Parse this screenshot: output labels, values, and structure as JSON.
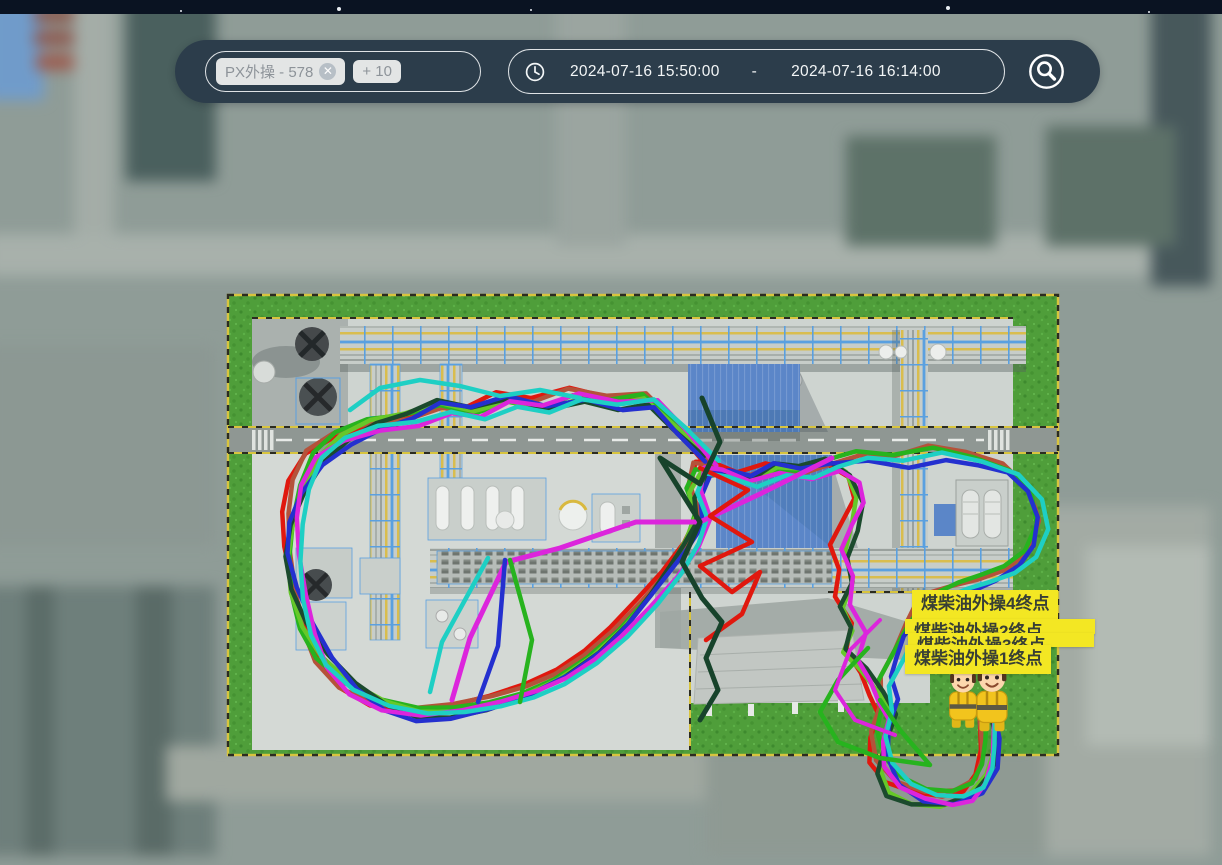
{
  "toolbar": {
    "tag_input": {
      "tags": [
        {
          "label": "PX外操 - 578",
          "closable": true
        },
        {
          "label": "+ 10",
          "closable": false
        }
      ]
    },
    "time_range": {
      "start": "2024-07-16 15:50:00",
      "separator": "-",
      "end": "2024-07-16 16:14:00"
    },
    "icons": {
      "clock": "clock-icon",
      "search": "circle-search-icon",
      "close": "close-icon"
    }
  },
  "topbar": {
    "stars": [
      [
        180,
        10,
        2
      ],
      [
        337,
        7,
        4
      ],
      [
        530,
        9,
        2
      ],
      [
        946,
        6,
        4
      ],
      [
        1148,
        11,
        2
      ]
    ]
  },
  "colors": {
    "toolbar_bg": "#2c3d4b",
    "topbar_bg": "#0a1322",
    "pill_border": "#f8fbfc",
    "chip_bg": "#e3e5e5",
    "chip_text": "#8d9399",
    "label_bg": "#f3e723",
    "label_text": "#383f35",
    "grass": "#4f9e3a",
    "concrete": "#ced4d0",
    "building_blue": "#5b86c8",
    "rack_frame_blue": "#5aa0e0",
    "pipe_yellow": "#d9bd4e"
  },
  "map": {
    "endpoint_labels": [
      {
        "text": "煤柴油外操4终点",
        "x": 912,
        "y": 590,
        "clip": false
      },
      {
        "text": "煤柴油外操2终点",
        "x": 905,
        "y": 619,
        "clip": true,
        "w": 172,
        "clip_h": 13
      },
      {
        "text": "煤柴油外操3终点",
        "x": 908,
        "y": 633,
        "clip": true,
        "w": 168,
        "clip_h": 12
      },
      {
        "text": "煤柴油外操1终点",
        "x": 905,
        "y": 645,
        "clip": false
      }
    ],
    "workers": {
      "count": 2,
      "description": "worker-avatar-markers"
    },
    "trail_prefix": [
      [
        706,
        458
      ],
      [
        676,
        428
      ],
      [
        648,
        400
      ],
      [
        614,
        404
      ],
      [
        578,
        396
      ],
      [
        542,
        406
      ],
      [
        506,
        398
      ],
      [
        472,
        410
      ],
      [
        440,
        404
      ],
      [
        408,
        417
      ],
      [
        374,
        424
      ],
      [
        342,
        438
      ],
      [
        316,
        458
      ],
      [
        299,
        488
      ],
      [
        290,
        520
      ],
      [
        288,
        554
      ],
      [
        294,
        590
      ],
      [
        306,
        626
      ],
      [
        323,
        658
      ],
      [
        349,
        686
      ],
      [
        381,
        705
      ],
      [
        416,
        714
      ],
      [
        452,
        712
      ],
      [
        490,
        704
      ],
      [
        527,
        692
      ],
      [
        561,
        676
      ],
      [
        593,
        654
      ],
      [
        621,
        628
      ],
      [
        647,
        598
      ],
      [
        669,
        570
      ],
      [
        687,
        543
      ],
      [
        699,
        518
      ],
      [
        693,
        492
      ],
      [
        702,
        470
      ],
      [
        722,
        470
      ],
      [
        748,
        478
      ],
      [
        774,
        466
      ],
      [
        801,
        470
      ],
      [
        828,
        462
      ]
    ],
    "trail_variants": {
      "a": [
        [
          850,
          476
        ],
        [
          859,
          500
        ],
        [
          851,
          526
        ],
        [
          841,
          552
        ],
        [
          849,
          578
        ],
        [
          841,
          604
        ],
        [
          854,
          628
        ],
        [
          847,
          652
        ],
        [
          864,
          672
        ],
        [
          877,
          694
        ],
        [
          889,
          714
        ],
        [
          881,
          740
        ],
        [
          877,
          768
        ],
        [
          889,
          790
        ],
        [
          914,
          800
        ],
        [
          944,
          803
        ],
        [
          969,
          795
        ],
        [
          985,
          775
        ],
        [
          992,
          748
        ],
        [
          989,
          718
        ],
        [
          987,
          698
        ]
      ],
      "b": [
        [
          862,
          456
        ],
        [
          900,
          461
        ],
        [
          938,
          453
        ],
        [
          974,
          460
        ],
        [
          1007,
          470
        ],
        [
          1029,
          492
        ],
        [
          1037,
          520
        ],
        [
          1029,
          548
        ],
        [
          1011,
          566
        ],
        [
          987,
          578
        ],
        [
          961,
          588
        ],
        [
          937,
          598
        ],
        [
          917,
          612
        ],
        [
          904,
          632
        ],
        [
          894,
          655
        ],
        [
          884,
          678
        ],
        [
          889,
          702
        ],
        [
          881,
          728
        ],
        [
          884,
          757
        ],
        [
          899,
          781
        ],
        [
          924,
          795
        ],
        [
          953,
          797
        ],
        [
          977,
          787
        ],
        [
          989,
          765
        ],
        [
          991,
          738
        ],
        [
          988,
          712
        ],
        [
          986,
          697
        ]
      ]
    },
    "trails": [
      {
        "name": "trail-red",
        "color": "#e0180e",
        "variant": "a",
        "offset": -6,
        "amp": 5,
        "phase": 0.3
      },
      {
        "name": "trail-brown",
        "color": "#b5523a",
        "variant": "b",
        "offset": -4,
        "amp": 6,
        "phase": 1.1
      },
      {
        "name": "trail-green",
        "color": "#27b31e",
        "variant": "b",
        "offset": -2,
        "amp": 5,
        "phase": 2.2
      },
      {
        "name": "trail-lightgreen",
        "color": "#66c829",
        "variant": "a",
        "offset": 0,
        "amp": 4,
        "phase": 3.0
      },
      {
        "name": "trail-darkgreen",
        "color": "#1b4a2d",
        "variant": "a",
        "offset": 2,
        "amp": 5,
        "phase": 4.1
      },
      {
        "name": "trail-blue",
        "color": "#2430cf",
        "variant": "b",
        "offset": 4,
        "amp": 5,
        "phase": 5.0
      },
      {
        "name": "trail-magenta",
        "color": "#dc25dc",
        "variant": "a",
        "offset": 6,
        "amp": 6,
        "phase": 0.8
      },
      {
        "name": "trail-cyan",
        "color": "#1ecfc4",
        "variant": "b",
        "offset": 8,
        "amp": 5,
        "phase": 1.9
      }
    ],
    "tangles": [
      {
        "color": "#dc25dc",
        "width": 5,
        "points": [
          [
            832,
            458
          ],
          [
            760,
            494
          ],
          [
            700,
            522
          ],
          [
            636,
            522
          ],
          [
            560,
            548
          ],
          [
            506,
            562
          ],
          [
            470,
            638
          ],
          [
            452,
            700
          ]
        ]
      },
      {
        "color": "#e0180e",
        "width": 4.5,
        "points": [
          [
            700,
            468
          ],
          [
            748,
            490
          ],
          [
            710,
            516
          ],
          [
            752,
            542
          ],
          [
            700,
            566
          ],
          [
            732,
            592
          ],
          [
            760,
            572
          ],
          [
            742,
            614
          ],
          [
            706,
            640
          ]
        ]
      },
      {
        "color": "#17432b",
        "width": 5,
        "points": [
          [
            702,
            398
          ],
          [
            720,
            442
          ],
          [
            700,
            484
          ],
          [
            660,
            458
          ],
          [
            700,
            522
          ],
          [
            682,
            562
          ],
          [
            702,
            598
          ],
          [
            722,
            622
          ],
          [
            706,
            658
          ],
          [
            718,
            690
          ],
          [
            700,
            720
          ]
        ]
      },
      {
        "color": "#27b31e",
        "width": 4.5,
        "points": [
          [
            510,
            560
          ],
          [
            532,
            640
          ],
          [
            520,
            702
          ]
        ]
      },
      {
        "color": "#1ecfc4",
        "width": 4.5,
        "points": [
          [
            488,
            558
          ],
          [
            442,
            642
          ],
          [
            430,
            692
          ]
        ]
      },
      {
        "color": "#2430cf",
        "width": 4.5,
        "points": [
          [
            505,
            560
          ],
          [
            498,
            646
          ],
          [
            478,
            702
          ]
        ]
      },
      {
        "color": "#27b31e",
        "width": 4.5,
        "points": [
          [
            868,
            648
          ],
          [
            838,
            680
          ],
          [
            820,
            712
          ],
          [
            838,
            742
          ],
          [
            880,
            758
          ],
          [
            930,
            765
          ],
          [
            900,
            730
          ],
          [
            880,
            700
          ]
        ]
      },
      {
        "color": "#dc25dc",
        "width": 4,
        "points": [
          [
            880,
            620
          ],
          [
            850,
            650
          ],
          [
            835,
            690
          ],
          [
            855,
            720
          ],
          [
            895,
            735
          ]
        ]
      },
      {
        "color": "#1ecfc4",
        "width": 4.5,
        "points": [
          [
            350,
            410
          ],
          [
            380,
            388
          ],
          [
            420,
            380
          ],
          [
            460,
            386
          ],
          [
            500,
            396
          ],
          [
            540,
            390
          ],
          [
            580,
            398
          ]
        ]
      }
    ]
  }
}
